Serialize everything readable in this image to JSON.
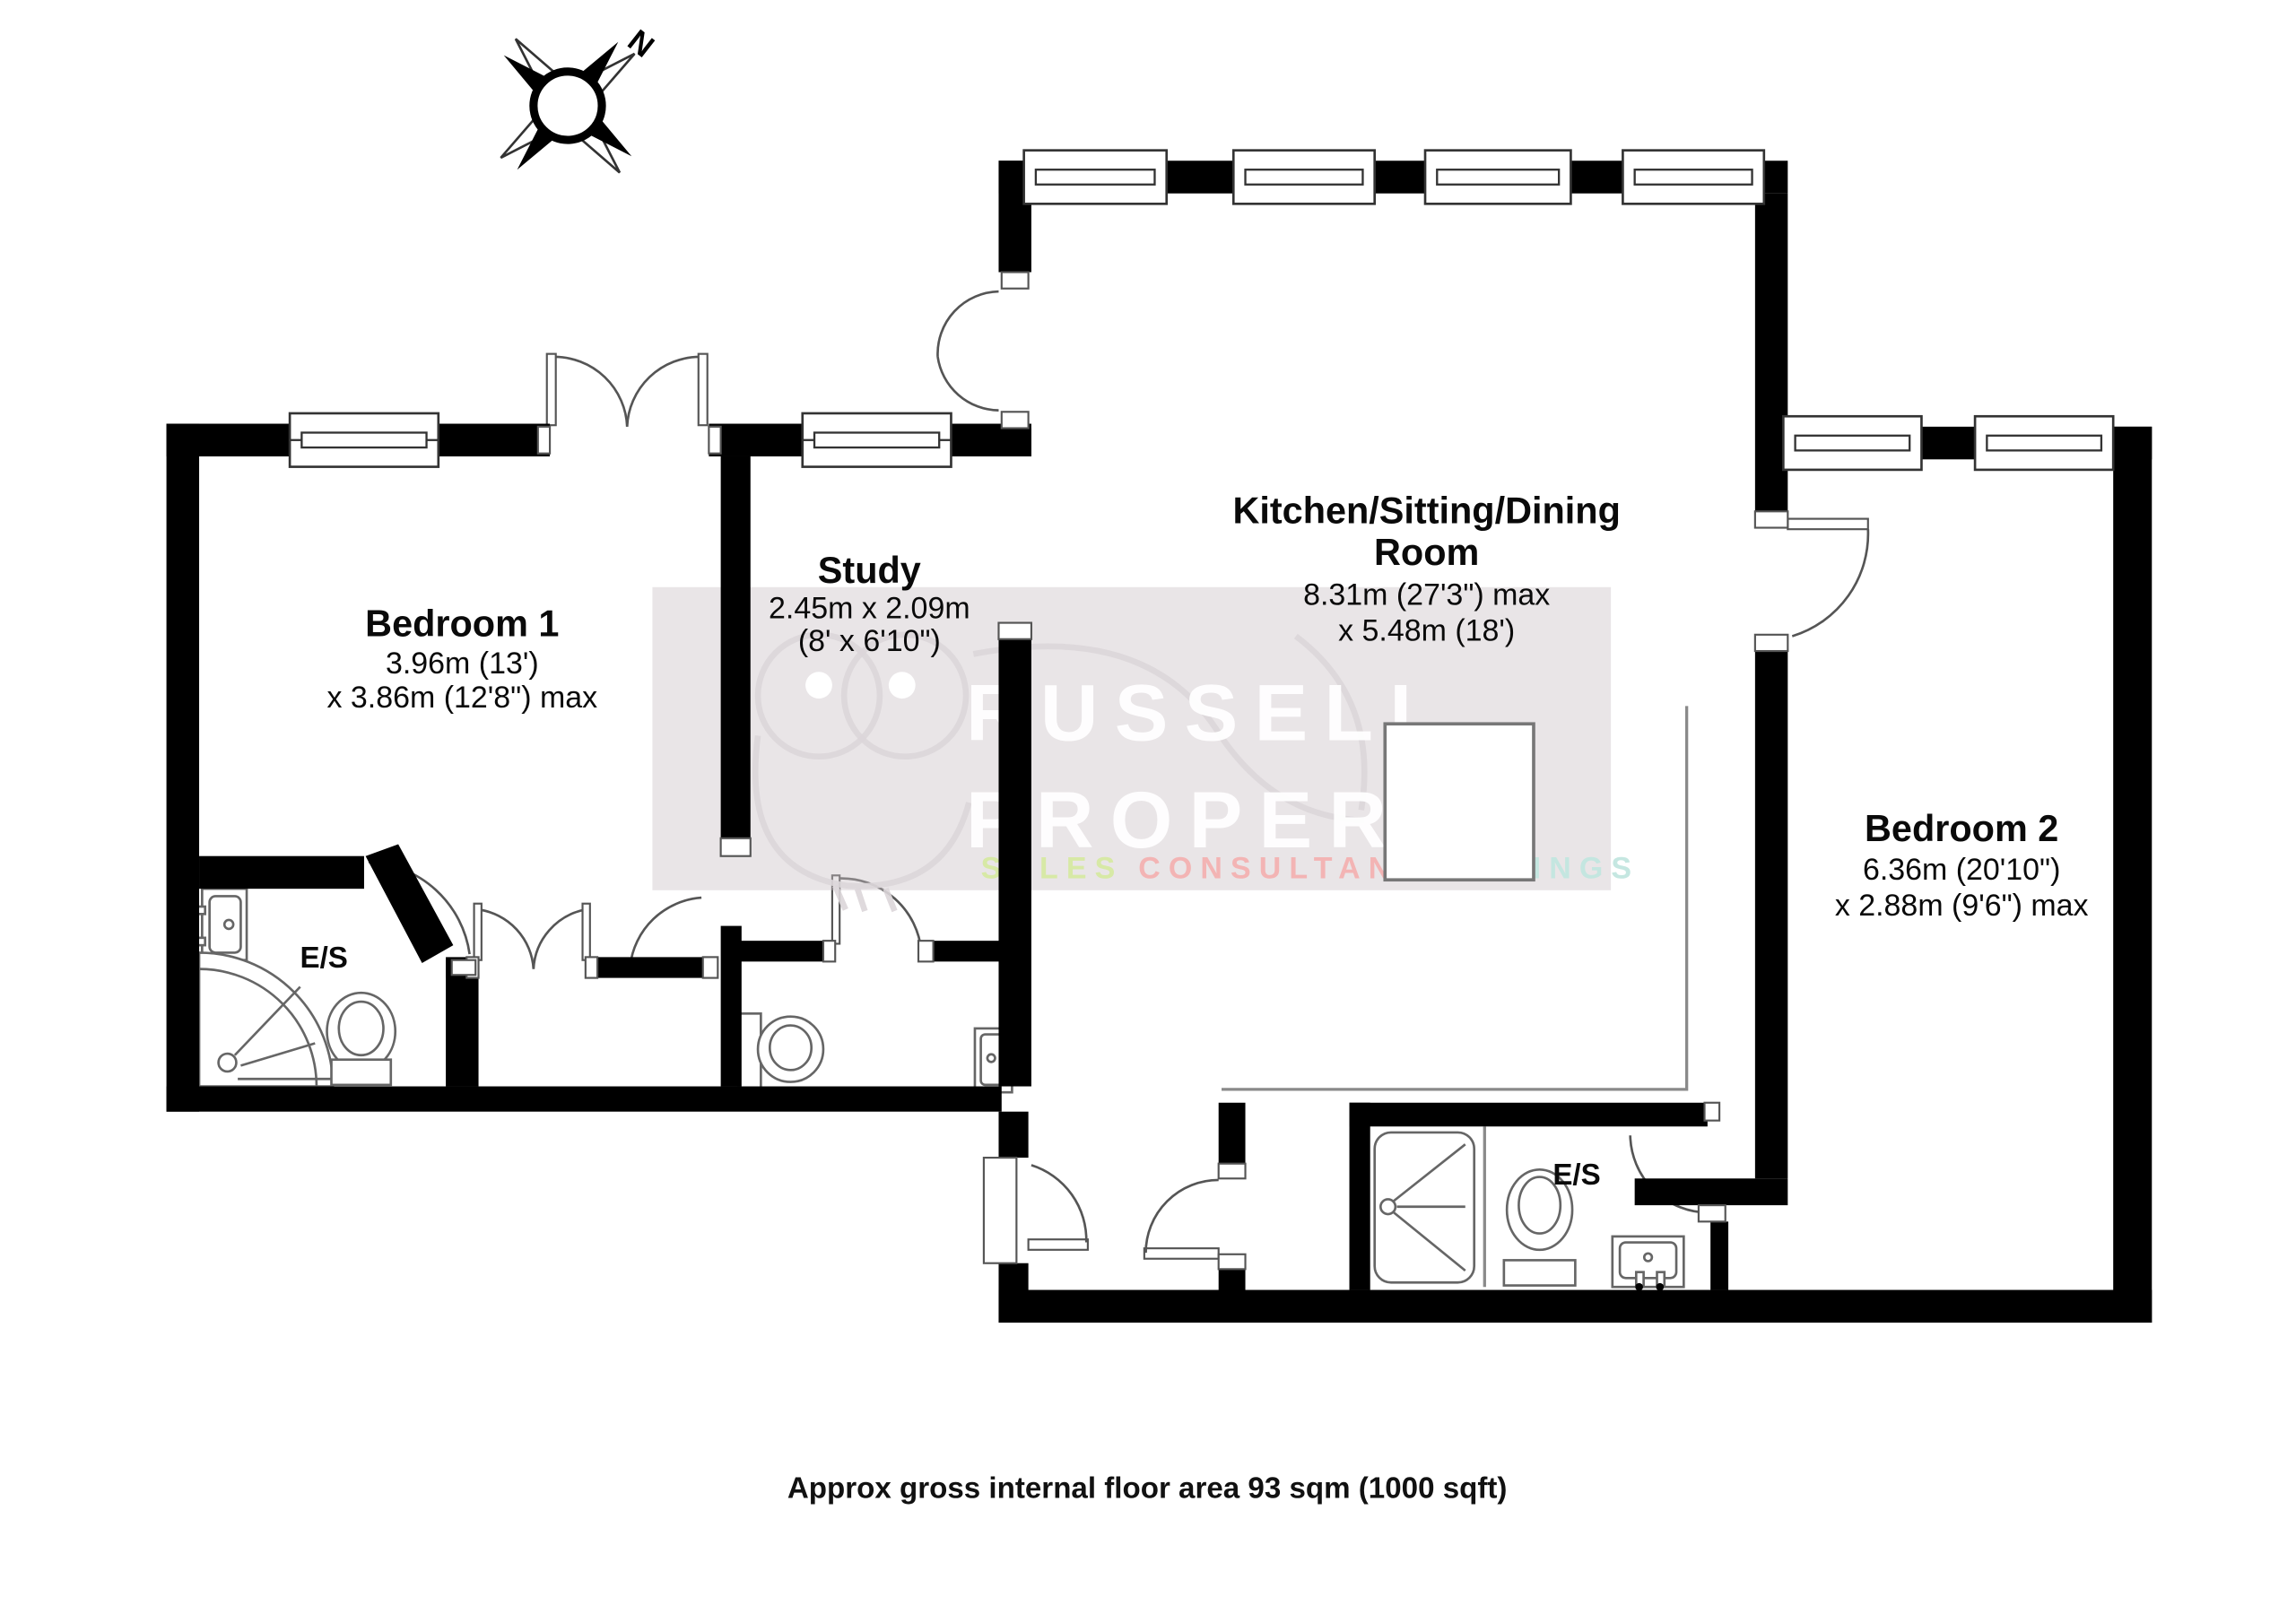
{
  "caption": "Approx gross internal floor area 93 sqm (1000 sqft)",
  "compass": {
    "label": "N"
  },
  "watermark": {
    "band_color": "#cbc0c6",
    "line1": "RUSSELL",
    "line2": "PROPERTY",
    "line3": [
      {
        "text": "SALES",
        "color": "#d6e9a2"
      },
      {
        "text": "CONSULTANCY",
        "color": "#f3b1b1"
      },
      {
        "text": "LETTINGS",
        "color": "#c2e6df"
      }
    ]
  },
  "rooms": {
    "bedroom1": {
      "name": "Bedroom 1",
      "dim_metric": "3.96m (13')",
      "dim_imperial": "x 3.86m (12'8\") max"
    },
    "study": {
      "name": "Study",
      "dim_metric": "2.45m x 2.09m",
      "dim_imperial": "(8' x 6'10\")"
    },
    "kitchen": {
      "name_line1": "Kitchen/Sitting/Dining",
      "name_line2": "Room",
      "dim_metric": "8.31m (27'3\") max",
      "dim_imperial": "x 5.48m (18')"
    },
    "bedroom2": {
      "name": "Bedroom 2",
      "dim_metric": "6.36m (20'10\")",
      "dim_imperial": "x 2.88m (9'6\") max"
    },
    "ensuite1": {
      "name": "E/S"
    },
    "ensuite2": {
      "name": "E/S"
    }
  }
}
